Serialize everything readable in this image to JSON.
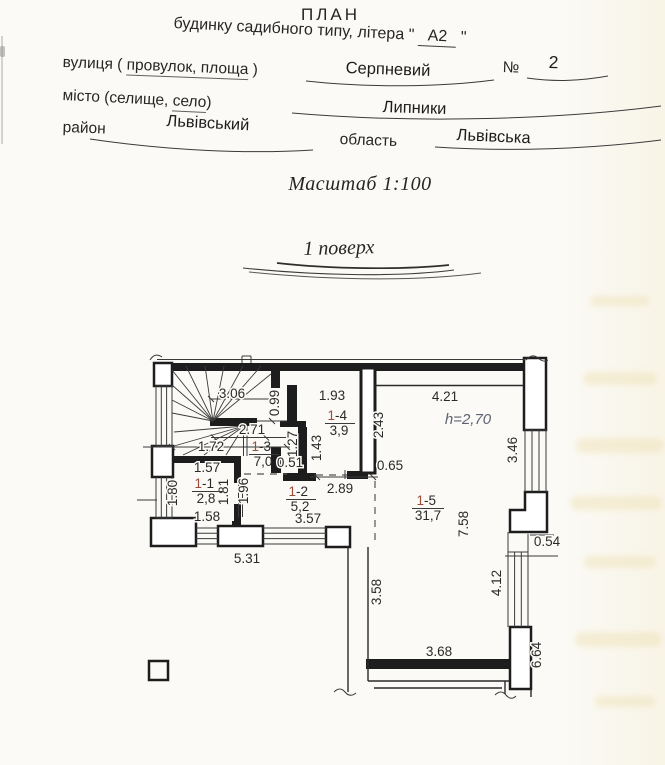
{
  "document": {
    "title": "ПЛАН",
    "subtitle": {
      "prefix": "будинку садибного типу, літера \" ",
      "value": "А2",
      "suffix": " \""
    },
    "fields": {
      "street_label_pre": "вулиця ( ",
      "street_label_mid": "провулок, площа",
      "street_label_post": " )",
      "street_value": "Серпневий",
      "number_sign": "№",
      "number_value": "2",
      "city_label_pre": "місто (селище, ",
      "city_label_mid": "село",
      "city_label_post": ")",
      "city_value": "Липники",
      "district_label": "район",
      "district_value": "Львівський",
      "region_label": "область",
      "region_value": "Львівська"
    },
    "scale_note": "Масштаб 1:100",
    "floor_title": "1 поверх"
  },
  "plan": {
    "height_note": "h=2,70",
    "rooms": [
      {
        "id": "1-1",
        "num_prefix": "1",
        "num_suffix": "-1",
        "area": "2,8"
      },
      {
        "id": "1-2",
        "num_prefix": "1",
        "num_suffix": "-2",
        "area": "5,2"
      },
      {
        "id": "1-3",
        "num_prefix": "1",
        "num_suffix": "-3",
        "area": "7,0"
      },
      {
        "id": "1-4",
        "num_prefix": "1",
        "num_suffix": "-4",
        "area": "3,9"
      },
      {
        "id": "1-5",
        "num_prefix": "1",
        "num_suffix": "-5",
        "area": "31,7"
      }
    ],
    "dimensions": {
      "stair_top": "3.06",
      "opening_top": "0.99",
      "room4_width": "1.93",
      "room5_width": "4.21",
      "flue_height": "2.43",
      "hall_width": "2.71",
      "stair_width": "1.72",
      "door_127": "1.27",
      "room4_depth": "1.43",
      "door_051": "0.51",
      "window_right_top": "3.46",
      "stub_065": "0.65",
      "room1_width_top": "1.57",
      "door_289": "2.89",
      "room1_depth_left": "1.80",
      "room1_depth_right": "1.81",
      "room2_depth": "1.96",
      "room5_depth": "7.58",
      "room1_width_bottom": "1.58",
      "window_bottom_inner": "3.57",
      "step_054": "0.54",
      "window_bottom_outer": "5.31",
      "window_right_bottom": "4.12",
      "wall_lower_left": "3.58",
      "room5_bottom": "3.68",
      "side_lower_right": "6.64"
    }
  },
  "colors": {
    "accent_room_number": "#9e4a38",
    "height_note_ink": "#5c6270",
    "ink": "#262626"
  }
}
